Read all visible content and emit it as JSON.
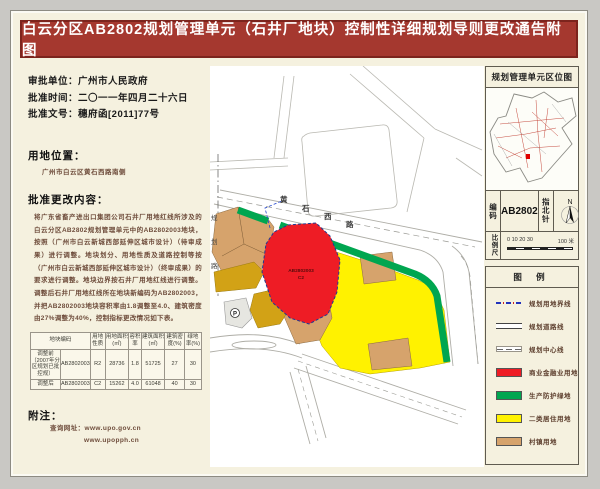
{
  "title": "白云分区AB2802规划管理单元（石井厂地块）控制性详细规划导则更改通告附图",
  "colors": {
    "title_bg": "#a5382f",
    "panel_bg": "#f5f1df",
    "commercial_red": "#ee1c25",
    "green_buffer": "#00a650",
    "residential_yellow": "#fff200",
    "village_tan": "#d6a36c",
    "village_gold": "#d2a216"
  },
  "left_panel": {
    "fields": [
      {
        "label": "审批单位：",
        "value": "广州市人民政府"
      },
      {
        "label": "批准时间：",
        "value": "二〇一一年四月二十六日"
      },
      {
        "label": "批准文号：",
        "value": "穗府函[2011]77号"
      }
    ],
    "location": {
      "heading": "用地位置：",
      "text": "广州市白云区黄石西路南侧"
    },
    "content": {
      "heading": "批准更改内容：",
      "text": "将广东省畜产进出口集团公司石井厂用地红线所涉及的白云分区AB2802规划管理单元中的AB2802003地块，按照（广州市白云新城西部延伸区城市设计）（待审成果）进行调整。地块划分、用地性质及道路控制等按（广州市白云新城西部延伸区城市设计）（终审成果）的要求进行调整。地块边界按石井厂用地红线进行调整。调整后石井厂用地红线所在地块新编码为AB2802003，并把AB2802003地块容积率由1.8调整至4.0、建筑密度由27%调整为40%，控制指标更改情况如下表。"
    },
    "table": {
      "headers": [
        "地块编码",
        "用地性质",
        "用地面积(㎡)",
        "容积率",
        "建筑面积(㎡)",
        "建筑密度(%)",
        "绿地率(%)"
      ],
      "rows": [
        {
          "label": "调整前（2007年分区规划已批控规）",
          "code": "AB2802003",
          "use": "R2",
          "area": "28736",
          "far": "1.8",
          "gfa": "51725",
          "density": "27",
          "green": "30"
        },
        {
          "label": "调整后",
          "code": "AB2802003",
          "use": "C2",
          "area": "15262",
          "far": "4.0",
          "gfa": "61048",
          "density": "40",
          "green": "30"
        }
      ]
    },
    "notes": {
      "heading": "附注：",
      "query_label": "查询网址：",
      "urls": [
        "www.upo.gov.cn",
        "www.upopph.cn"
      ]
    }
  },
  "map": {
    "road_name": "黄石西路",
    "road_name_chars": [
      "黄",
      "石",
      "西",
      "路"
    ],
    "side_road_chars": [
      "规",
      "划",
      "路"
    ],
    "parcel_code": "AB2802003",
    "parcel_use": "C2",
    "parking_label": "P"
  },
  "sidebar": {
    "locator_title": "规划管理单元区位图",
    "code_label": "编码",
    "code_value": "AB2802",
    "compass_label": "指北针",
    "compass_n": "N",
    "scale_label": "比例尺",
    "scale_ticks": "0 10 20 30",
    "scale_end": "100 米",
    "legend": {
      "heading": "图  例",
      "line_items": [
        {
          "label": "规划用地界线"
        },
        {
          "label": "规划道路线"
        },
        {
          "label": "规划中心线"
        }
      ],
      "fill_items": [
        {
          "label": "商业金融业用地",
          "color": "#ee1c25"
        },
        {
          "label": "生产防护绿地",
          "color": "#00a650"
        },
        {
          "label": "二类居住用地",
          "color": "#fff200"
        },
        {
          "label": "村镇用地",
          "color": "#d6a36c"
        }
      ]
    }
  }
}
